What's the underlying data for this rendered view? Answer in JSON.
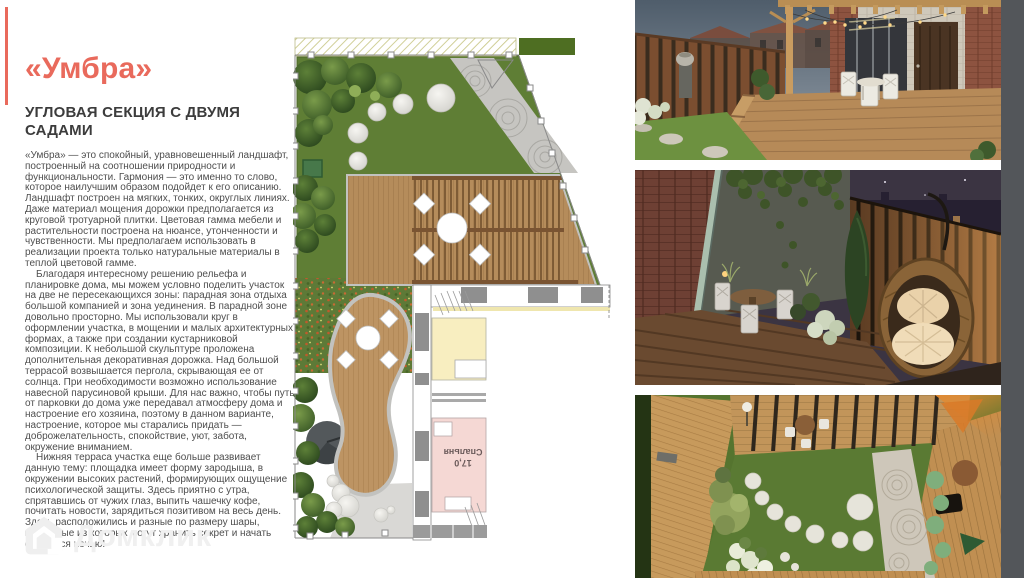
{
  "page": {
    "title": "«Умбра»",
    "subtitle": "УГЛОВАЯ СЕКЦИЯ С ДВУМЯ САДАМИ",
    "paragraphs": [
      "«Умбра» — это спокойный, уравновешенный ландшафт, построенный на соотношении природности и функциональности. Гармония — это именно то слово, которое наилучшим образом подойдет к его описанию. Ландшафт построен на мягких, тонких, округлых линиях. Даже материал мощения дорожки предполагается из круговой тротуарной плитки. Цветовая гамма мебели и растительности построена на нюансе, утонченности и чувственности. Мы предполагаем использовать в реализации проекта только натуральные материалы в теплой цветовой гамме.",
      "Благодаря интересному решению рельефа и планировке дома, мы можем условно поделить участок на две не пересекающихся зоны: парадная зона отдыха большой компанией и зона уединения. В парадной зоне довольно просторно. Мы использовали круг в оформлении участка, в мощении и малых архитектурных формах, а также при создании кустарниковой композиции. К небольшой скульптуре проложена дополнительная декоративная дорожка. Над большой террасой возвышается пергола, скрывающая ее от солнца. При необходимости возможно использование навесной парусиновой крыши. Для нас важно, чтобы путь от парковки до дома уже передавал атмосферу дома и настроение его хозяина, поэтому в данном варианте, настроение, которое мы старались придать — доброжелательность, спокойствие, уют, забота, окружение вниманием.",
      "Нижняя терраса участка еще больше развивает данную тему: площадка имеет форму зародыша, в окружении высоких растений, формирующих ощущение психологической защиты. Здесь приятно с утра, спрятавшись от чужих глаз, выпить чашечку кофе, почитать новости, зарядиться позитивом на весь день. Здесь расположились и разные по размеру шары, некоторые из которых могут хранить секрет и начать светиться ночью!"
    ],
    "watermark_label": "Домклик",
    "colors": {
      "accent": "#e96a5c",
      "side_strip": "#53565a"
    }
  },
  "plan": {
    "room_area": "17,0",
    "room_name": "Спальня"
  }
}
